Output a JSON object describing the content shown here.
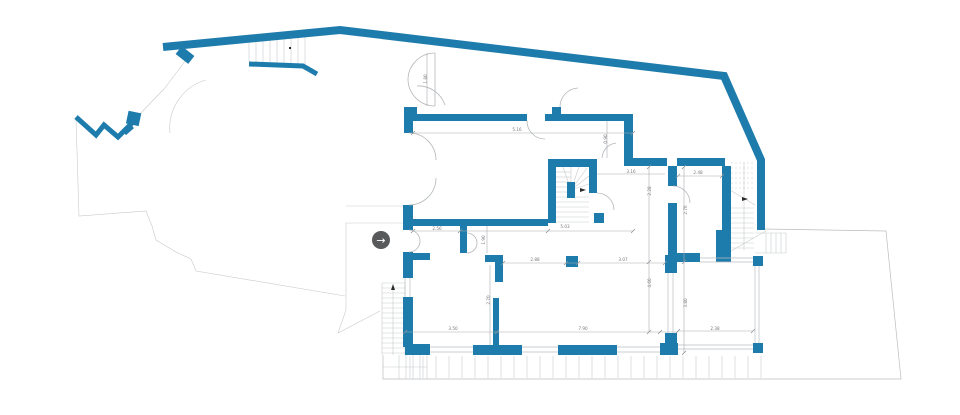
{
  "plan": {
    "type": "architectural-floor-plan",
    "wall_color": "#1e7cac",
    "line_color": "#b9bdc0",
    "dim_text_color": "#77797c",
    "background": "#ffffff"
  },
  "nav_button": {
    "glyph": "→",
    "bg": "#58595b",
    "fg": "#ffffff"
  },
  "dimensions": [
    {
      "x": 517,
      "y": 131,
      "rot": 0,
      "text": "5.16"
    },
    {
      "x": 437,
      "y": 230,
      "rot": 0,
      "text": "2.56"
    },
    {
      "x": 565,
      "y": 228,
      "rot": 0,
      "text": "5.03"
    },
    {
      "x": 535,
      "y": 261,
      "rot": 0,
      "text": "2.88"
    },
    {
      "x": 623,
      "y": 261,
      "rot": 0,
      "text": "3.07"
    },
    {
      "x": 453,
      "y": 330,
      "rot": 0,
      "text": "3.50"
    },
    {
      "x": 583,
      "y": 330,
      "rot": 0,
      "text": "7.90"
    },
    {
      "x": 715,
      "y": 330,
      "rot": 0,
      "text": "2.38"
    },
    {
      "x": 698,
      "y": 174,
      "rot": 0,
      "text": "2.48"
    },
    {
      "x": 631,
      "y": 173,
      "rot": 0,
      "text": "3.16"
    },
    {
      "x": 651,
      "y": 283,
      "rot": -90,
      "text": "4.60"
    },
    {
      "x": 687,
      "y": 303,
      "rot": -90,
      "text": "3.80"
    },
    {
      "x": 651,
      "y": 191,
      "rot": -90,
      "text": "2.28"
    },
    {
      "x": 687,
      "y": 210,
      "rot": -90,
      "text": "2.76"
    },
    {
      "x": 485,
      "y": 240,
      "rot": -90,
      "text": "1.90"
    },
    {
      "x": 607,
      "y": 139,
      "rot": -90,
      "text": "0.90"
    },
    {
      "x": 490,
      "y": 300,
      "rot": -90,
      "text": "2.70"
    },
    {
      "x": 427,
      "y": 79,
      "rot": -90,
      "text": "1.80"
    }
  ]
}
